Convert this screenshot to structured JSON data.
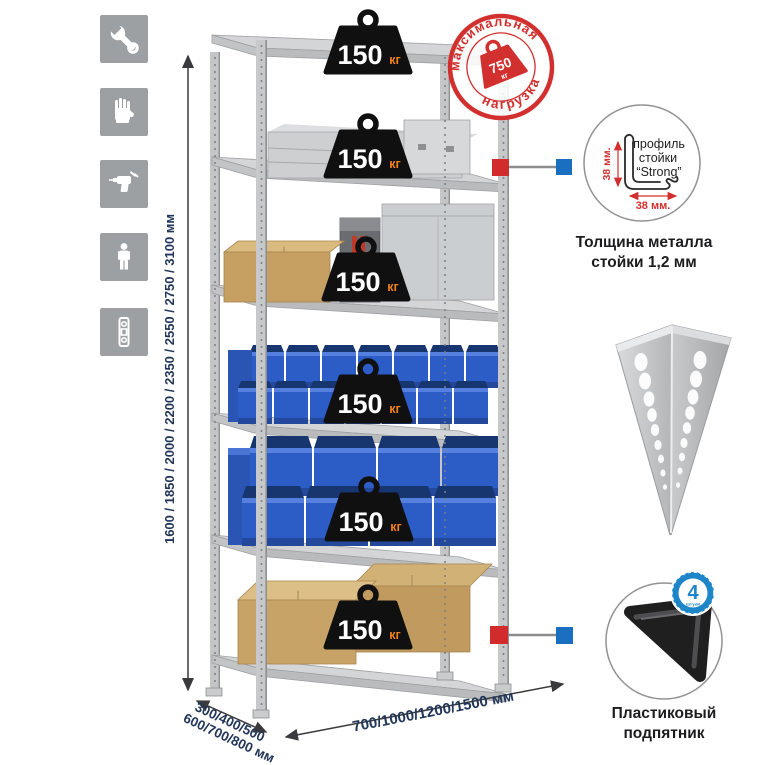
{
  "left_toolbar": {
    "icons": [
      {
        "name": "wrench"
      },
      {
        "name": "gloves"
      },
      {
        "name": "drill"
      },
      {
        "name": "person-height"
      },
      {
        "name": "level"
      }
    ]
  },
  "dimensions": {
    "height": "1600 / 1850 / 2000 / 2200 / 2350 / 2550 / 2750 / 3100 мм",
    "depth_line1": "300/400/500",
    "depth_line2": "600/700/800 мм",
    "width": "700/1000/1200/1500 мм"
  },
  "shelf_weights": [
    {
      "value": "150",
      "unit": "кг"
    },
    {
      "value": "150",
      "unit": "кг"
    },
    {
      "value": "150",
      "unit": "кг"
    },
    {
      "value": "150",
      "unit": "кг"
    },
    {
      "value": "150",
      "unit": "кг"
    },
    {
      "value": "150",
      "unit": "кг"
    }
  ],
  "max_load_stamp": {
    "arc_top": "максимальная",
    "arc_bottom": "нагрузка",
    "value": "750",
    "unit": "кг"
  },
  "profile_detail": {
    "line1": "профиль",
    "line2": "стойки",
    "line3": "“Strong”",
    "dim_vertical": "38 мм.",
    "dim_horizontal": "38 мм.",
    "caption_line1": "Толщина металла",
    "caption_line2": "стойки 1,2 мм"
  },
  "foot_detail": {
    "badge_number": "4",
    "badge_unit": "штуки",
    "badge_arc": "в комплекте",
    "caption_line1": "Пластиковый",
    "caption_line2": "подпятник"
  },
  "colors": {
    "stamp_red": "#d2302e",
    "weight_black": "#101010",
    "weight_unit_orange": "#f08118",
    "bin_blue": "#2c5cc5",
    "connector_red": "#d22b2b",
    "connector_blue": "#1b6fc0",
    "metal_gray": "#c6c8ca",
    "dim_navy": "#22365a",
    "badge_blue": "#1c86c8",
    "icon_gray": "#9da0a3"
  }
}
